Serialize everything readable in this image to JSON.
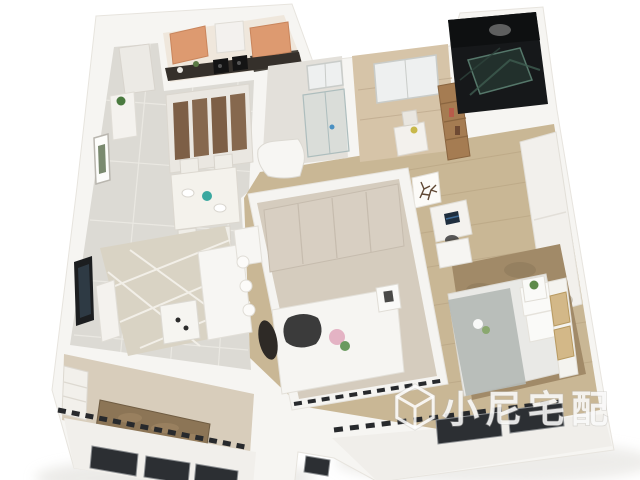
{
  "scene": {
    "type": "3d-apartment-floorplan-render",
    "view": "isometric cutaway from above",
    "background_color": "#ffffff"
  },
  "watermark": {
    "text": "小尼宅配",
    "logo_icon": "cube-logo-icon",
    "text_color": "#ffffff",
    "outline_color": "#b8b6b1",
    "opacity": 0.8
  },
  "palette": {
    "wall_white": "#f6f5f2",
    "wall_face": "#f0eeea",
    "tile_floor": "#dcdad4",
    "wood_floor": "#c9b795",
    "kitchen_cabinet_orange": "#dd9a70",
    "countertop_dark": "#35302b",
    "dark_bathroom": "#16181a",
    "glass_green": "#3f5c50",
    "living_rug": "#d9d3c4",
    "master_rug_brown": "#a18a68",
    "balcony_rug_brown": "#8c7556",
    "bedding_gray": "#b4bab6",
    "window_dark": "#2c2f33",
    "bookshelf_wood": "#a57c52",
    "headboard_art_gold": "#d3b888"
  },
  "rooms": [
    {
      "name": "entry-hall"
    },
    {
      "name": "kitchen"
    },
    {
      "name": "dining-area"
    },
    {
      "name": "living-room"
    },
    {
      "name": "bathroom"
    },
    {
      "name": "study"
    },
    {
      "name": "dark-bathroom"
    },
    {
      "name": "hallway"
    },
    {
      "name": "second-bedroom"
    },
    {
      "name": "master-bedroom"
    },
    {
      "name": "balcony"
    }
  ]
}
